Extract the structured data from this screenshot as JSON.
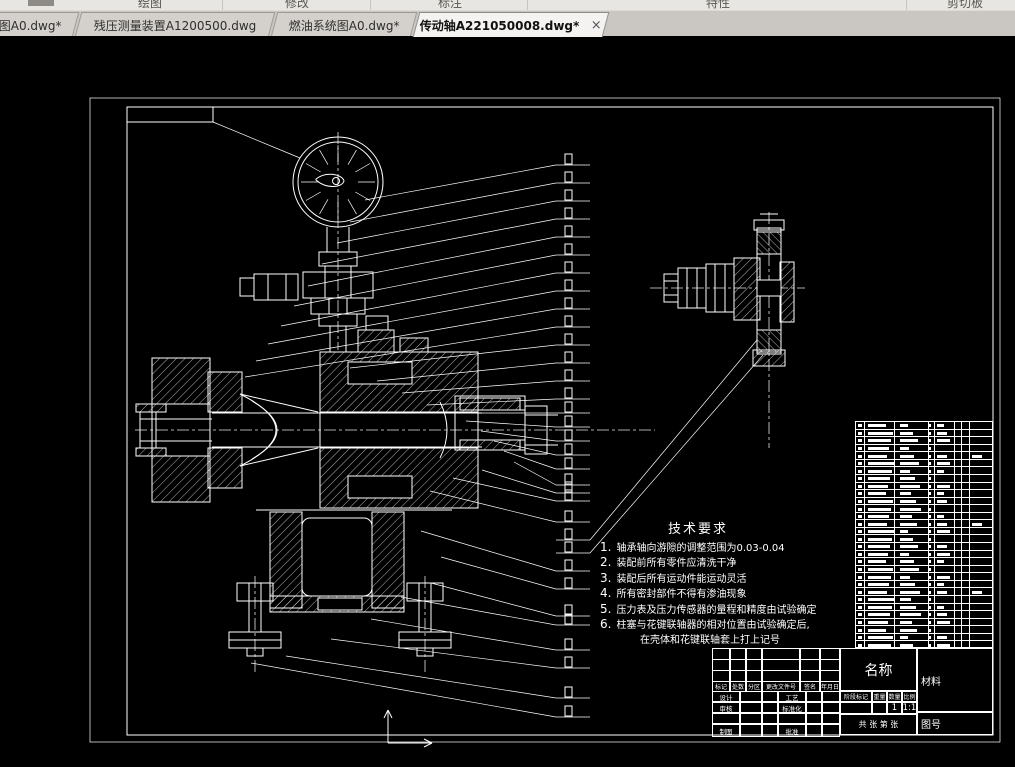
{
  "ribbon": {
    "groups": [
      {
        "label": "绘图"
      },
      {
        "label": "修改"
      },
      {
        "label": "标注"
      },
      {
        "label": "特性"
      },
      {
        "label": "剪切板"
      }
    ]
  },
  "tab_bar": {
    "close_icon": "×",
    "tabs": [
      {
        "label": "图A0.dwg*",
        "active": false
      },
      {
        "label": "残压测量装置A1200500.dwg",
        "active": false
      },
      {
        "label": "燃油系统图A0.dwg*",
        "active": false
      },
      {
        "label": "传动轴A221050008.dwg*",
        "active": true
      }
    ]
  },
  "drawing": {
    "tech_requirements": {
      "title": "技术要求",
      "items": [
        "轴承轴向游隙的调整范围为0.03-0.04",
        "装配前所有零件应清洗干净",
        "装配后所有运动件能运动灵活",
        "所有密封部件不得有渗油现象",
        "压力表及压力传感器的量程和精度由试验确定",
        "柱塞与花键联轴器的相对位置由试验确定后,"
      ],
      "continuation": "在壳体和花键联轴套上打上记号"
    },
    "title_block": {
      "revision_headers": [
        "标记",
        "处数",
        "分区",
        "更改文件号",
        "签名",
        "年月日"
      ],
      "signature_rows": [
        {
          "left": "设计",
          "mid": "工艺"
        },
        {
          "left": "审核",
          "mid": "标准化"
        },
        {
          "left": "",
          "mid": ""
        },
        {
          "left": "制图",
          "mid": "批准"
        }
      ],
      "name_label": "名称",
      "stage_headers": [
        "阶段标记",
        "重量",
        "数量",
        "比例"
      ],
      "stage_values": [
        "",
        "",
        "1",
        "1:1"
      ],
      "sheet_label": "共 张 第 张",
      "material_label": "材料",
      "drawing_no_label": "图号"
    },
    "bom": {
      "row_count": 30
    },
    "colors": {
      "paper_border": "#c8860a",
      "line": "#ffffff",
      "canvas_bg": "#000000"
    }
  }
}
